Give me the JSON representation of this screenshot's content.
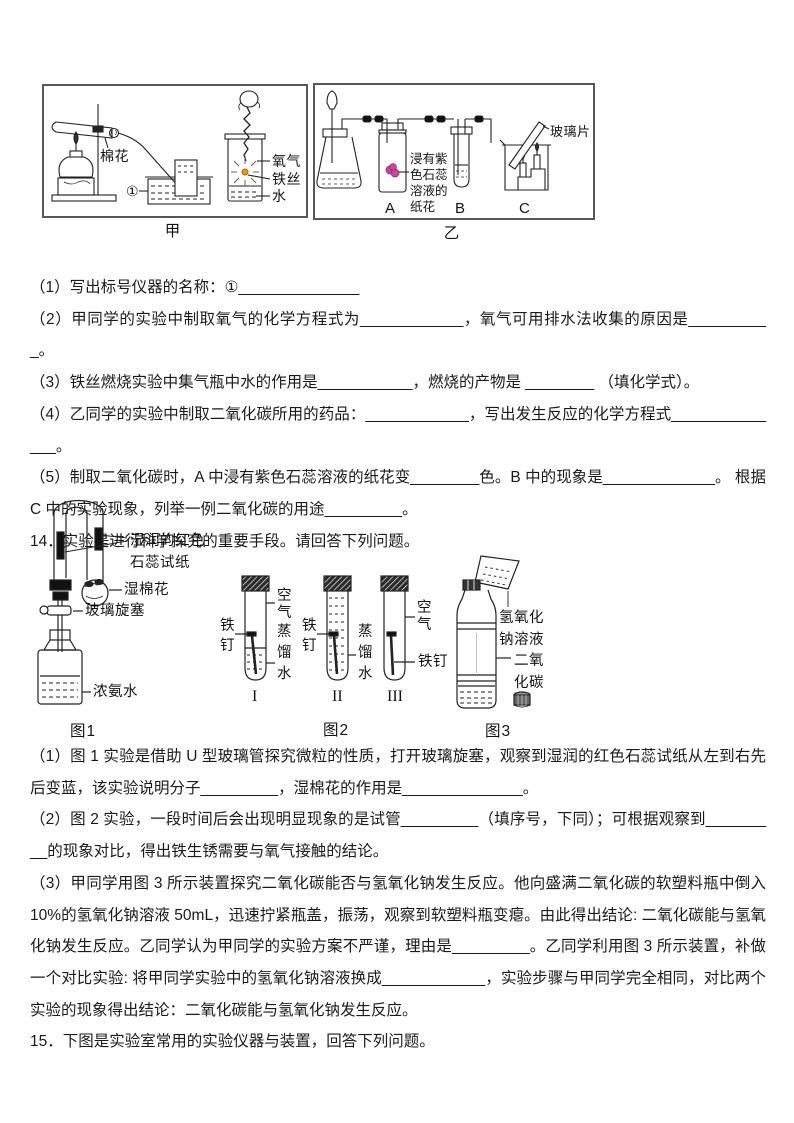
{
  "apparatus": {
    "jia": {
      "caption": "甲",
      "labels": {
        "cotton": "棉花",
        "circle1": "①",
        "oxygen": "氧气",
        "iron_wire": "铁丝",
        "water": "水"
      }
    },
    "yi": {
      "caption": "乙",
      "labels": {
        "flower": "浸有紫\n色石蕊\n溶液的\n纸花",
        "glass_slide": "玻璃片",
        "a": "A",
        "b": "B",
        "c": "C"
      }
    }
  },
  "q13": {
    "parts": [
      "（1）写出标号仪器的名称：①______________",
      "（2）甲同学的实验中制取氧气的化学方程式为____________，氧气可用排水法收集的原因是__________。",
      "（3）铁丝燃烧实验中集气瓶中水的作用是___________，燃烧的产物是 ________ （填化学式）。",
      "（4）乙同学的实验中制取二氧化碳所用的药品：____________，写出发生反应的化学方程式______________。",
      "（5）制取二氧化碳时，A 中浸有紫色石蕊溶液的纸花变________色。B 中的现象是_____________。 根据 C 中的实验现象，列举一例二氧化碳的用途_________。"
    ]
  },
  "q14": {
    "intro": "14．实验是进行科学探究的重要手段。请回答下列问题。",
    "fig1": {
      "caption": "图1",
      "labels": {
        "litmus_paper": "湿润的红色\n石蕊试纸",
        "wet_cotton": "湿棉花",
        "stopcock": "玻璃旋塞",
        "ammonia": "浓氨水"
      }
    },
    "fig2": {
      "caption": "图2",
      "labels": {
        "nail1": "铁\n钉",
        "air1": "空\n气",
        "dwater1": "蒸\n馏\n水",
        "nail2": "铁\n钉",
        "dwater2": "蒸\n馏\n水",
        "air3": "空\n气",
        "nail3": "铁钉",
        "num1": "I",
        "num2": "II",
        "num3": "III"
      }
    },
    "fig3": {
      "caption": "图3",
      "labels": {
        "naoh": "氢氧化\n钠溶液",
        "co2": "二氧\n化碳"
      }
    },
    "parts": [
      "（1）图 1 实验是借助 U 型玻璃管探究微粒的性质，打开玻璃旋塞，观察到湿润的红色石蕊试纸从左到右先后变蓝，该实验说明分子_________，湿棉花的作用是______________。",
      "（2）图 2 实验，一段时间后会出现明显现象的是试管_________（填序号，下同）；可根据观察到_________的现象对比，得出铁生锈需要与氧气接触的结论。",
      "（3）甲同学用图 3 所示装置探究二氧化碳能否与氢氧化钠发生反应。他向盛满二氧化碳的软塑料瓶中倒入 10%的氢氧化钠溶液 50mL，迅速拧紧瓶盖，振荡，观察到软塑料瓶变瘪。由此得出结论: 二氧化碳能与氢氧化钠发生反应。乙同学认为甲同学的实验方案不严谨，理由是_________。乙同学利用图 3 所示装置，补做一个对比实验: 将甲同学实验中的氢氧化钠溶液换成____________，实验步骤与甲同学完全相同，对比两个实验的现象得出结论：二氧化碳能与氢氧化钠发生反应。"
    ]
  },
  "q15": {
    "intro": "15．下图是实验室常用的实验仪器与装置，回答下列问题。"
  }
}
